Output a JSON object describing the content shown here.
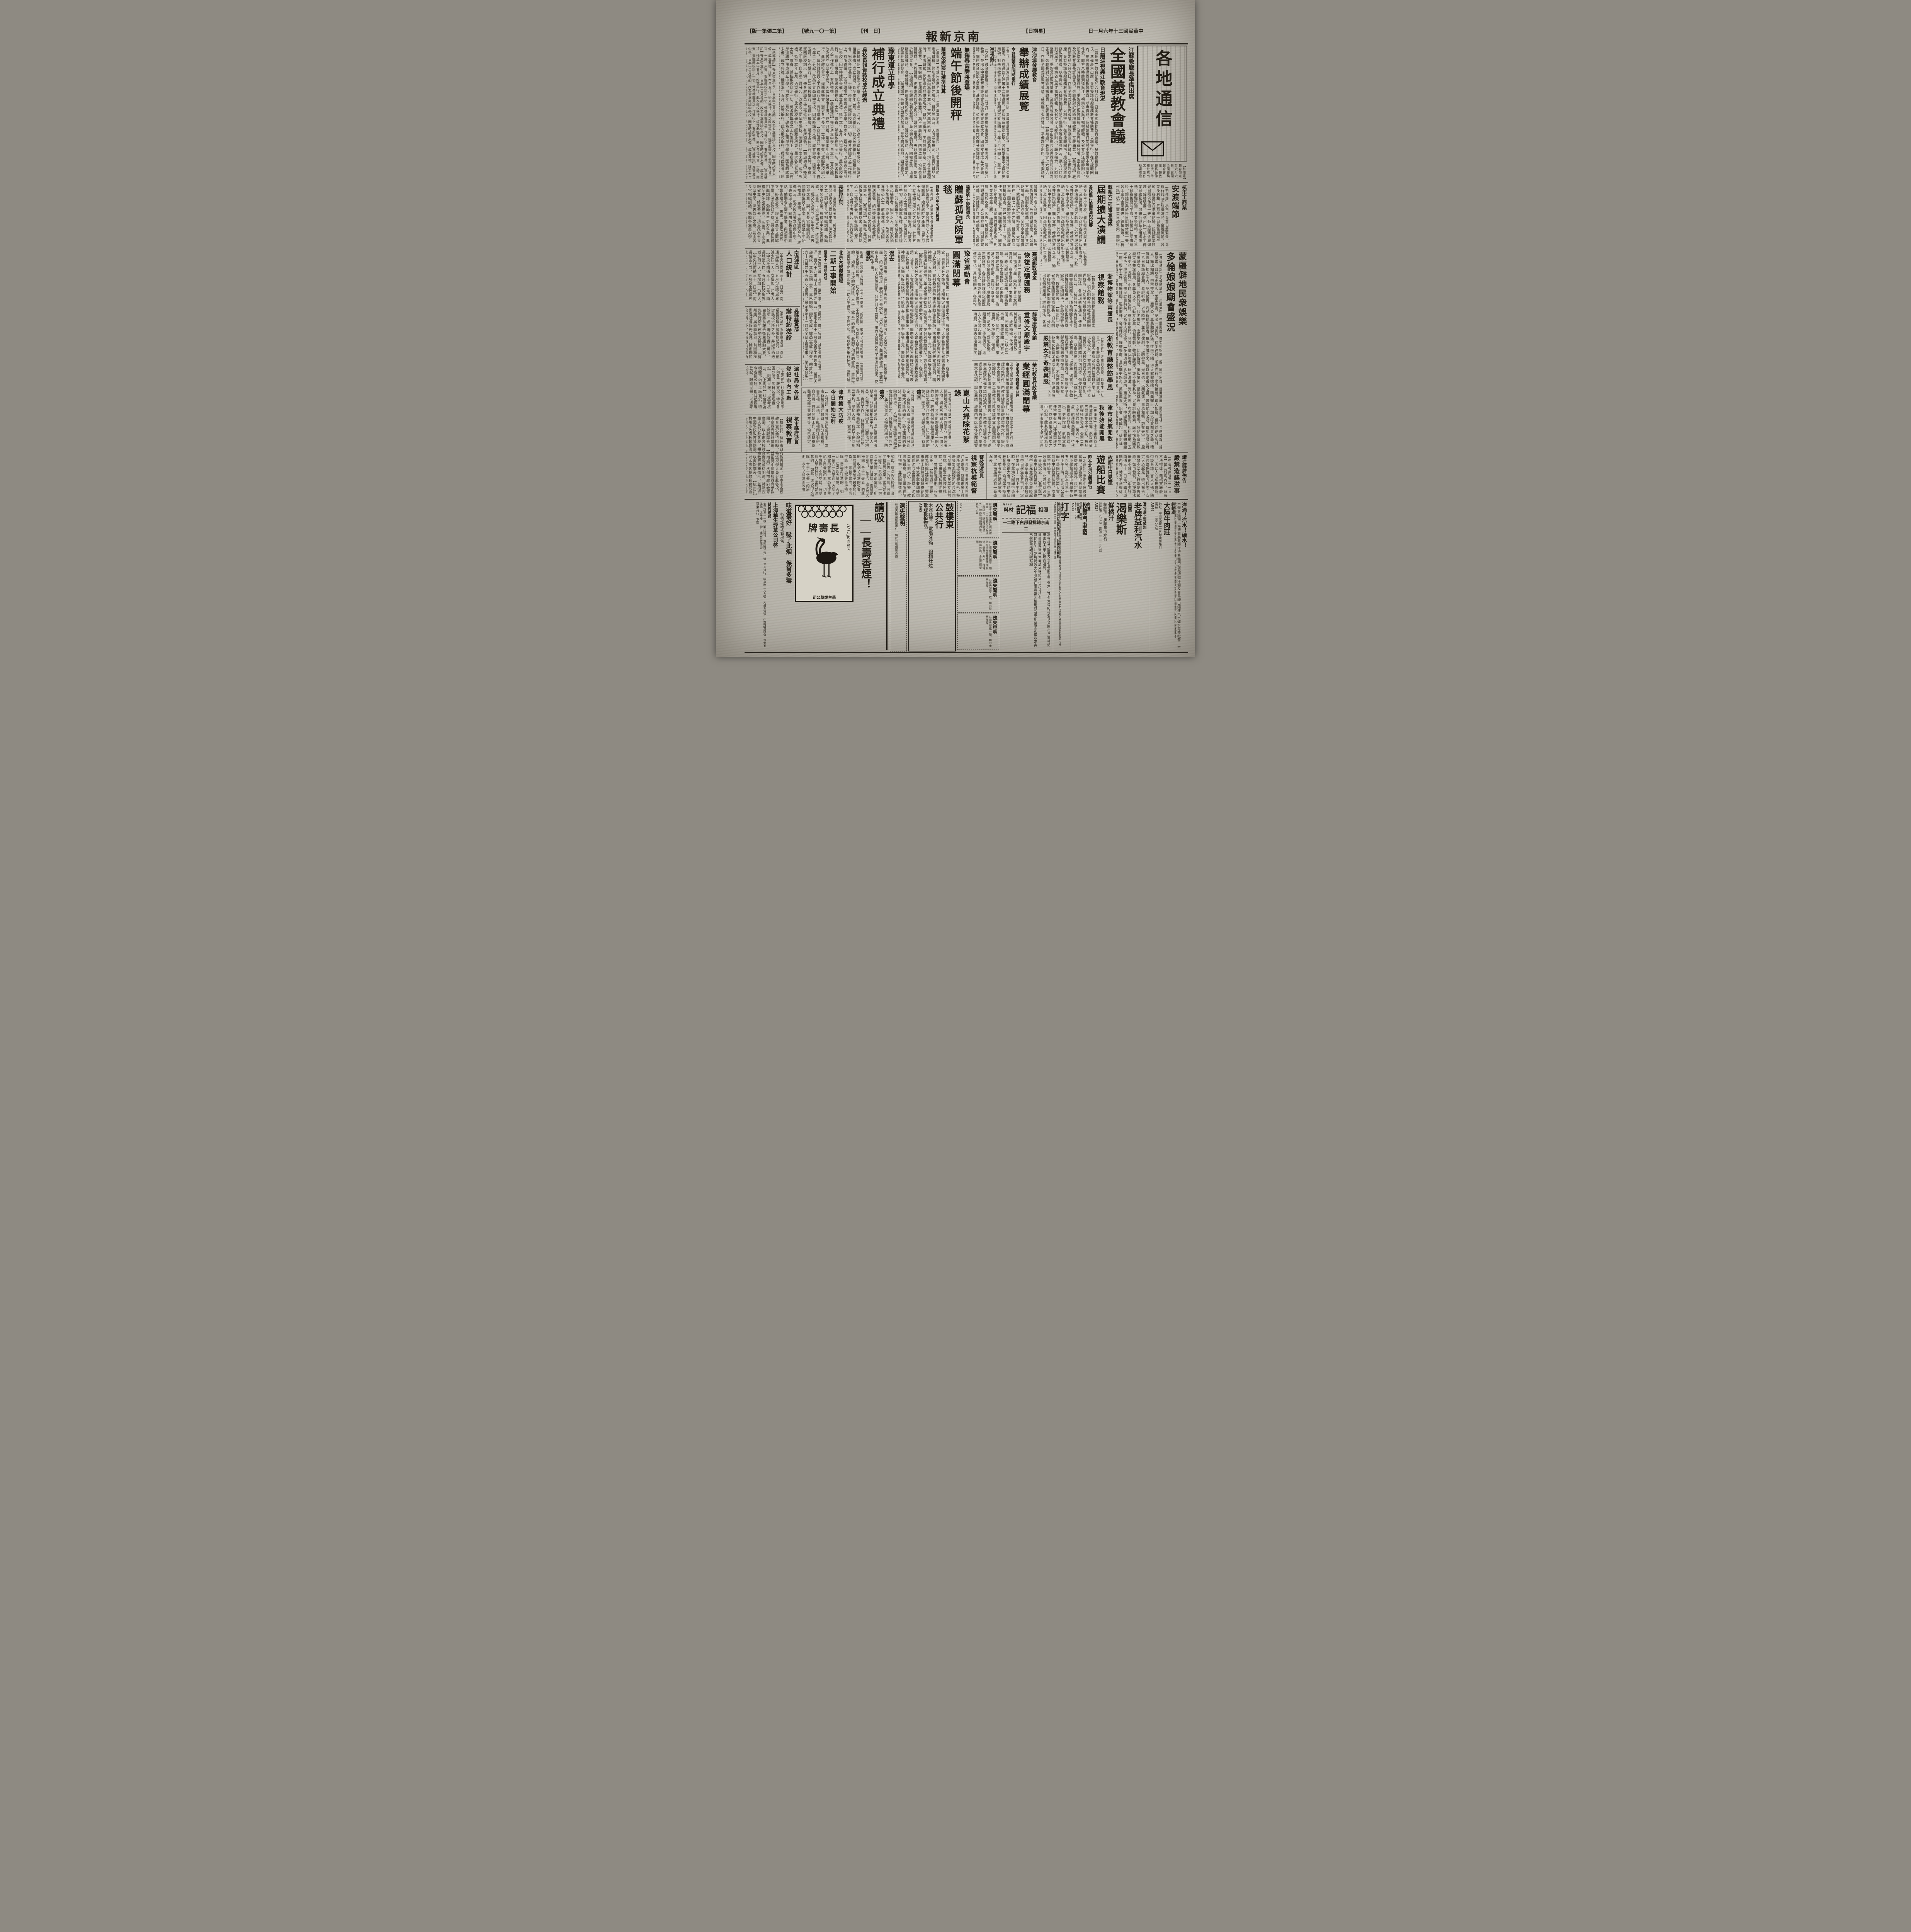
{
  "header": {
    "date": "中華民國三十年六月一日",
    "weekday": "星期日",
    "masthead": "南京新報",
    "daily": "日　刊",
    "issue": "第一〇一九號",
    "edition": "第二張第一版"
  },
  "logo": {
    "text": "各地通信"
  },
  "articles": {
    "quanguo": {
      "kicker": "江蘇教廳長準備出席",
      "title": "全國義教會議",
      "subtitle": "日前巡視吳江教育現況",
      "body": "【蘇州訊】教育部定於六月六日、召開全國義務教育會議、蘇教廳長張仲賢氏、準備赴京出席、並有擬請核撥義務教育補助費、以利推行、在可能範圍內、應設置視導義務教育專員、以專責成、及擬請編訂簡易小學課本等提案多件云、廳方八時餘到達吳江、視察省立吳江鄉村師範、及省立吳江鄉師附小、頗多指示、九時餘至縣府、垂詢吳江教育情形、及教育經費各項、當由張縣長及馬教育局長詳為答復、張廳長對於該縣增籌教費、甚表滿意、"
    },
    "jinhaidao": {
      "kicker": "津海道發展教育",
      "title": "舉辦成績展覽",
      "subtitle": "令各縣定期同時舉行",
      "body": "五日止、凡津海道所屬各縣同時舉辦、其成績展覽會辦法、業已由津海道公署擬定、昨經通飭天津等十二縣遵照、預料該道創辦此舉、各校學生因之自加要用功、對未來教育當有裨益、㈠會期規定於民國三十年六月十四日、至十五日、㈡各縣同時舉辦、㈢展覽會場、由縣選擇適當地點、㈣凡屬公私立中小學校之作品、應於六月末以前、造具清冊、並一律粘掛標籤、連同成績品一併呈送道公署、以備考核、㈨各種成績品、經道公署品評、認為優良者、分別給予獎狀獎品、以資鼓勵、㈩道公署評判辦法、另訂之、",
      "subhead": "巡視吳江",
      "body2": "【又訊】教育廳張廳長、前日（廿九）偕同廳祕書張仰高、彭世芳、巡視吳江教育、並出席中國教育建設協會吳江縣支會成立大會、聞縣支會成立大會訓話、闡述教育建設之意義、甚為詳盡、並由張祕書代表蘇分會訓話、下午一時視察縣立中學、縣立實驗小學、及縣立民衆教育館、至會於七時半由三時左右始返廳云、"
    },
    "duanwu": {
      "kicker": "無錫春繭瞬將登場",
      "title": "端午節後開秤",
      "subtitle": "繭價依照部訂標準計算",
      "body": "【無錫訊】吾錫向為著名蠶汛、莫不興高彩烈、四鄉農民、均年發售蠶種時、老牌蠶種、仍形求過於供之現狀、蠶兒三眠時、天時寒暖無定、影響於蠶兒發育、",
      "body2": "據聞今年各小絲廠、對於收繭、因去年虧蝕關係、故抱觀望態度、大公司方面、則擬收買乾繭、預計蠶戶共烘乾繭者、為數必多、至於今年鮮繭價格、依照農礦訂定價格計算、大致每担在一百七八十元之譜、蠶桑改良區方面、因春繭瞬將登場、該區原設改良捐稽查處、茲已增設至十一所、俾便切實稽查云、端節關係繁忙、關於整個廟會期、金融依然穩定現象、則各業之神靈之庥、"
    },
    "yudong": {
      "kicker": "豫東道立中學",
      "title": "補行成立典禮",
      "subtitle": "吳校長報告該校成立經過",
      "body": "【商邱通訊】豫東道立中學、自本年二月分起、改為省立商邱中學校、因當時諸事未備、成立典禮、延至本年五月、始克舉行、此次敝校舉行、經藉此機會、懇求各位長官、士紳、來賓、駕臨敝校訓示一切、俾各教職員之工作進行上、有所遵循、",
      "subhead": "長官訓詞",
      "body2": "等畫、主張改歸省立、終進云云、現又改為省立商邱中學、深表歡迎之意、嗣由各長官相繼訓話、勉勵各生努力學業、典禮至中午始告禮成、"
    },
    "hangshang": {
      "kicker": "杭市工商業",
      "title": "安渡端節",
      "body": "【杭州訊】杭市工商業日趨繁榮、即銀行錢莊亦組織蓬勃、金融流通、各業多利賴、五月三十日為舊曆端午節、各業已在準備結賬、銀錢兩業於是日照例休假一天、各工廠商金屬煤煙、鐘樓裝蕭、"
    },
    "mengjiang": {
      "title1": "蒙疆僻地民衆娛樂",
      "title2": "多倫娘娘廟會盛況",
      "body": "【多倫通訊】多倫縣城內、東盛大街、中間路西、舊有娘娘廟一座、殿宇宏偉、廊廡壯麗、雕梁畫棟、金碧輝煌、鐘樓整肅、且以廟史悠久、萬里無雲、記者一時興起、徒步往觀、順道而行、摩肩接踵、遊人如蟻、但見沿途商店林立、櫛比如鱗、街市整潔、一塵不染、車馬馳騁於途、往來不絕、行人熙熙攘攘、精美耀目、加以呼買叫賣之聲、嘈雜震耳、擠入廟內、記者鼓勇、凡願祈福求嗣者、無不虔誠而來、是以斯廟香火之盛、實為他廟之冠、每年陰曆四月十八日為該廟會期、奉經祈禱、求神降祥、並舉行演戲、以酬神靈、是日也、天朗氣清、惠風和暢、蔚藍天空、一般紅男綠女、白叟黃童、絡繹於途、扶老攜幼、言歡笑語、比比皆是、攤販陳列、星羅棋布、商品琳瑯、所佔用窗內陳設完備整潔嚴肅、各職員人等、仍勤於公務、俯首苦幹、雖鑼鼓喧天、亦不能移其神、足見訓練有素、誠不愧為國家之幹吏也、遊覽一小時、體倦想歸、遂步出廟門、見賣兒童玩物者、羅列滿灘、泥人泥馬、布犬紙馬、栩栩欲動、五光十色、琳瑯滿目、盡呈於目前矣、足為後人所法也、"
    },
    "judu": {
      "kicker": "蘇組六三拒毒宣傳隊",
      "title": "屆期擴大演講",
      "subtitle": "各校舉行拒毒演說比賽",
      "body": "通令各中小學校、舉行拒毒演說比賽、㈤製發標語、及告民衆書、㈥商請各報館出版拒毒專刊、並表演拒毒性質之戲劇、於六三紀念屆期、分赴公共娛樂場所、擴大宣傳、俾便切實稽查云、"
    },
    "bowuguan": {
      "title1": "浙博物舘等兩館長",
      "title2": "視察館務",
      "body": "【杭州訊】浙省博物館圖書館兩館長、頃為明瞭各地社教機關辦理概況、分別出發視察館務、詳細辦法、各局均懸有通告、俾衆週知云、"
    },
    "zhefeng": {
      "title1": "浙教育廳整飭學風",
      "title2": "嚴禁女子奇裝異服",
      "body": "【杭州訊】浙省教育廳、以學生一切言行、各教職員悉應共負訓導責任、迭經函令市縣政府轉飭遵辦在案、茲以各校女生、亦應崇尚樸素、不得奇裝異服、各校女教員尤須以身作則、並須隨時隨地剴切訓導、勿使相習成風、以崇儉德、而維風氣、"
    },
    "minhang": {
      "title1": "津市民航閒散",
      "title2": "秋後始能開展",
      "body": "【天津訊】津市雖有京山津浦兩線之便、然以適值五河匯集之中心點、故其航運極為發達、全市集中之民船約在一萬六七千隻、航運極為蕭條、待秋後農產品登市、貨物進出、更將增加、航運當能漸次開展云、"
    },
    "juntan": {
      "kicker": "陸軍第十師謝師長",
      "title": "贈蘇孤兒院軍毯",
      "subtitle": "該院本月中旬補行開幕",
      "body": "【蘇州訊】吳縣私立孤兒教養院自開始籌備以來、蒙各界熱心人士慷慨解囊、始有該院之產生、自五月十五日起、先行開始收容教養、現合於手續已經入院之孤兒、計有五名、修葺院屋、購置用具、均蒙各界熱心人士同情捐助、該院擬於六月中旬、補行開幕典禮、惟每月經常費、仍在困難中、至本城各鎮長熱心補助者、固不乏人、而依然袖手不加憐者、亦屬不少、故仍希各界熱心人士、解囊救孤、培植國本、茲蒙暫編陸軍第十師謝師長、贈送軍毯、請送交該孤兒教養院、林副師長於該院初期之觀瞻、誠堪嘉許云、"
    },
    "wenmiao": {
      "kicker": "靜海唐官屯鎮",
      "title": "重修文廟殿宇",
      "body": "【靜海訊】頃據唐官屯鎮紳民呈稱、孔廟歷受致祭、歲時補修、代代相沿、罔敢或間、乃以此次事變、痛遭蹂躪、所有大成殿、星門、文昌閣、東西廡、及垣牆等、傾者傾、圮者圮、頹垣敗壁、殿廡兩旁、亟待興修、地方人士發起重修云、"
    },
    "yundong": {
      "title1": "豫省運動會",
      "title2": "圓滿閉幕",
      "body": "【開封訊】河南省垣第一屆全省運動大會、經教育廳積極籌備之下、各項事宜、皆有充分之準備、按照預定田徑順序進行、大會名譽會長省署係長致開會詞、祕書長、大會顧問持務機關長相繼致辭、繼由參加來賓方面綏靖公署代表田氏致祝辭、審判長李黎丹報告運動注意事項、末由運動員代表宣讀誓詞、精神飽滿、大顯良好之成績、特給獎五千元、學生每名十元、教職員每名五元、最後運動員退場、並由全體運動員三呼萬歲、並分別發給獎品、方告舉行閉幕、"
    },
    "nongchang": {
      "kicker": "北京大規模農場",
      "title": "二期工事開始",
      "subtitle": "預定十一月底完成",
      "body": "業已大部完成、其第二期工事、亦已開始、即可完成、據悉全部工程費、約計洋一百六十九萬四千五百元之譜云、預定本年十一月底全部工程竣事、"
    },
    "renkou": {
      "kicker": "南通城區",
      "title": "人口統計",
      "body": "【中央社南通三十一日電】南通城區人口、五月份比較男界減少四一人、女增加一〇五人、"
    },
    "songzhen": {
      "kicker": "吳縣縣黨部",
      "title": "辦特約送診",
      "body": "【蘇州訊】吳縣縣黨部、前因積極辦理社會服務起見、除創辦民校六所之外、并辦特約送診所一處、籌印診券二萬張、由農縣長報告衛生運動大要、先舉行衛生運動大掃除、"
    },
    "kunshan": {
      "title": "崑山大掃除花絮錄",
      "body": "【本報崑山通訊】明媚的春天、已悄悄地逝去、薰熱的陽光、普照著大地、初夏已臨到人間了、一切可怕的時疫、將不斷的侵襲每一個人的身上、我們為保持身體健康計、應該怎樣來注意衛生、防止病菌的蔓延、因此、崑山縣府當局、有這次大掃除的舉行、參加的人員、一齊向民間宣傳、注意衛生、今天的大家看看罷了、詞意極為懇切、會場空氣、頓然的緊張起來、全體參加人員、精神都非常的振奮、畢、就分發掃帚畚箕等用具、開始掃除各街道、",
      "lead1": "這回",
      "body1": "大掃除、是經首屆縣政會議討論決定、各機關人員三呼之下、並分別發給大掃除的舉行、防止病菌的蔓延、因此崑山縣府當局、有這次掃除的舉行、",
      "lead2": "這次",
      "body2": "各機關掃除的地段、是由縣府預先擬定、分配得相當平均、參加人員、負荷了掃除用具、出發指定地段、實行工作、",
      "lead_past": "過去",
      "body_past": "的大掃除情形、我們且不去說它、果然大掃除收到了美滿的效果、花絮寫在下面、",
      "lead_though": "雖然",
      "body_though": "如此、這次的大掃除、合乎一做去一的原則、收到了相當的效果、當局是注重給予民衆的印象、一切合乎實際、不尚空談、所以那天舉行掃除、當局是注意的、"
    },
    "shichajy": {
      "kicker": "杭市縣府派員",
      "title": "視察教育",
      "body": "【杭州訊】杭州市政府教育廳函、以本市各校教育實況亟待明瞭、特派視學人員分赴各校、視察教育實施情形、並招待中國學校教育參觀團、以資觀摩云、"
    },
    "fangyi": {
      "title1": "津市擴大防疫",
      "title2": "今日開始注射",
      "body": "【天津訊】津市擴大防疫注射、本市各路要道注射班、則分金鋼橋、金華橋、旱橋、大紅橋四注射班、自六月一日起開始工作、各班檢疫醫師及護士書記生等、均已派定云、"
    },
    "gongchang": {
      "title1": "滬社局令各區",
      "title2": "登記市內工廠",
      "body": "【上海訊】社會局為明瞭市內各工廠實況、特令各區公所、即日起辦理登記、限期呈報、以憑考核云、"
    },
    "jingzheng": {
      "kicker": "警政部派員",
      "title": "視察杭模範警",
      "body": "【杭州訊】警政部為明瞭江浙兩省、暨滬市警士教練所辦理模範警情形、特派參事兼訓練司司長沈同出發視察、沈氏業於日前來杭、赴警士教練所視察、當由董所長陪往視察、並將辦理情形、報告沈氏、"
    },
    "huabei": {
      "kicker": "華北教育行政會議",
      "title": "業經圓滿閉幕",
      "subtitle": "決定通令辦理案四件",
      "body": "及收支教項清冊、呈署備查云、議案迄十四件、遂由主席將預備會議議決案件、計由教育總署通令辦理案件四件、由教育總署酌量辦理案件六件、提出由大會追認、詢無異議、旋即由主席宣佈全部議案討論終了、第二屆教育行政會議遂宣告圓滿閉幕、"
    },
    "youchuan": {
      "kicker": "故都中日兒童",
      "title": "遊船比賽",
      "subtitle": "昨在北海公園舉行",
      "body": "【北京訊】京市中日教育當局、頃為使中日兒童感情益敦睦起見、決定由中日小學校選派中日學生各五百名、定於本月三十一日上午十時、在北海公園舉行遊船比賽交歡大會、到時中日教育長官、均出席主持盛會、並有中日游泳家表演、北海屆時必有一番盛況云、"
    },
    "jingjiang": {
      "kicker": "靖江縣府佈告",
      "title": "嚴禁造謠滋事",
      "body": "【中央社南通三十一日電】靖江城廂內外、時有不法棍徒、藉端實施敲詐、因此人心愈形惶惑、街談巷議、言人人殊、陳縣長為保護地方秩序、安定人心起見、特出布告、嚴禁不法之人藉端陷害敲詐、如再發現、定按軍法嚴刑不貸云、"
    },
    "youzheng": {
      "kicker": "蕪湖郵政儲金",
      "title": "恢復定額匯務",
      "body": "【蕪湖訊】郵政儲金、簡便穩固、擔保可靠、向為各界士女所賞許者、在事變以前、本埠郵局、原已經辦是項業務、頗為發達、旋因事變停辦、迄未恢復、茲郵政當局、鑒於郵政儲金、為當今各界所需、業經呈奉令准、將原有儲金業務恢復、現雖僅及定額匯票、各界購匯該項定額匯票者、日漸增多、蓋亦利用其簡便可靠也、其詳細辦法、各局均懸有通告、俾衆週知云、"
    }
  },
  "ads": {
    "changshou": {
      "slogan1": "請吸",
      "slogan2": "——長壽香煙！",
      "brand": "長壽牌",
      "pack_side": "10 Cigarettes",
      "pack_maker": "華生煙草公司",
      "line1": "味道最好　吸了此烟　保爾多壽",
      "line2": "各香煙店均有出售",
      "company": "上海華生煙草公司啓",
      "exchange_title": "總掉換處",
      "exchange_body": "太平路三一一號　瀨川洋行　莫愁路二六二號　三井洋行　中華路二八九號　大昌五洋號　中華路寶輝巷　復大五洋號　太平路一一號　本公司宣傳部",
      "agent": "亞東商行　下關"
    },
    "lost_main": {
      "title": "遺失聲明",
      "body": "茲遺失圖章印鑑等件、特此登報聲明作廢、"
    },
    "auction": {
      "name1": "鼓樓東",
      "name2": "公共行",
      "items": "木器毯蓆　電扇冰箱　銀櫃灶爐",
      "tagline": "歡迎投拍物品",
      "code": "A965"
    },
    "lost1": {
      "title": "遺失聲明",
      "body": "茲遺失中央電訊社職員證章第三三三號長方形有邊正楷陽文、除呈請補發外、特此登報聲明作廢、張旭之啓",
      "code": "B3614"
    },
    "lost2": {
      "title": "遺失聲明",
      "body": "茲在揚州遺失圖章一顆、除在揚州登報聲明作廢外、倘有中外人士拾得、均屬無效、合應登報聲明、"
    },
    "lost3": {
      "title": "遺失聲明",
      "body": "茲遺失證章一枚、特此聲明作廢、"
    },
    "lost4": {
      "title": "迭失申明",
      "body": "茲迭失印鑑一顆、特此申明作廢、"
    },
    "fuji": {
      "cat1": "照相",
      "name": "福記",
      "cat2": "材料",
      "address": "南京總批發部白下路二一二",
      "line1": "利根櫻花筒裝及大包全紙五百張大六寸有光像紙均有現貨應市八重粗紙細面放大紙亦最近運到",
      "line2": "維羅娜厚簿半光面放大咪紙大小尺寸均有",
      "line3": "其他如AI乾片特製大小號箱在庫豐富照相用具及應用藥品定價非常克已荷蒙惠顧竭誠歡迎",
      "code": "A779"
    },
    "dazi": {
      "title": "打字",
      "body": "本所開辦歷十二載已呈奉市府批准備案現擴充添設城南城北分所以便利來學之士續招四十八期男女學員簡章函索附郵八分",
      "name": "南京市私立新民中西文字打字傳習所啓事",
      "addr": "埠石鼓路一三二號　城南分所評事街南市樓三號"
    },
    "shoumai": {
      "kicker": "高價",
      "title": "收買汽車廢",
      "items": "電池　車胎",
      "name": "大昌行啓",
      "addr": "碑亭巷十六號",
      "code": "A518"
    },
    "yili": {
      "kicker": "夏令最上等飲料",
      "title1": "老牌益利汽水",
      "title2a": "美國",
      "title2b": "渴樂斯",
      "title2c": "鮮橘汁",
      "agent": "總經理　廣順昌汽水行",
      "addr": "洪武路二八七號　電話二三一三八號",
      "code": "A827"
    },
    "dalu": {
      "headline": "洋酒！汽水！礦水！",
      "body": "本號專經理上海德商美最時洋行各種門祿冠牌號洋酒及青島嶗山縮達汽水礦水零整批發",
      "seller_label": "經銷處",
      "seller": "大陸牛肉莊",
      "addr": "地址　中山北路二一五號廣州路口",
      "phone": "電話　二一三六七號",
      "code": "A840"
    }
  }
}
